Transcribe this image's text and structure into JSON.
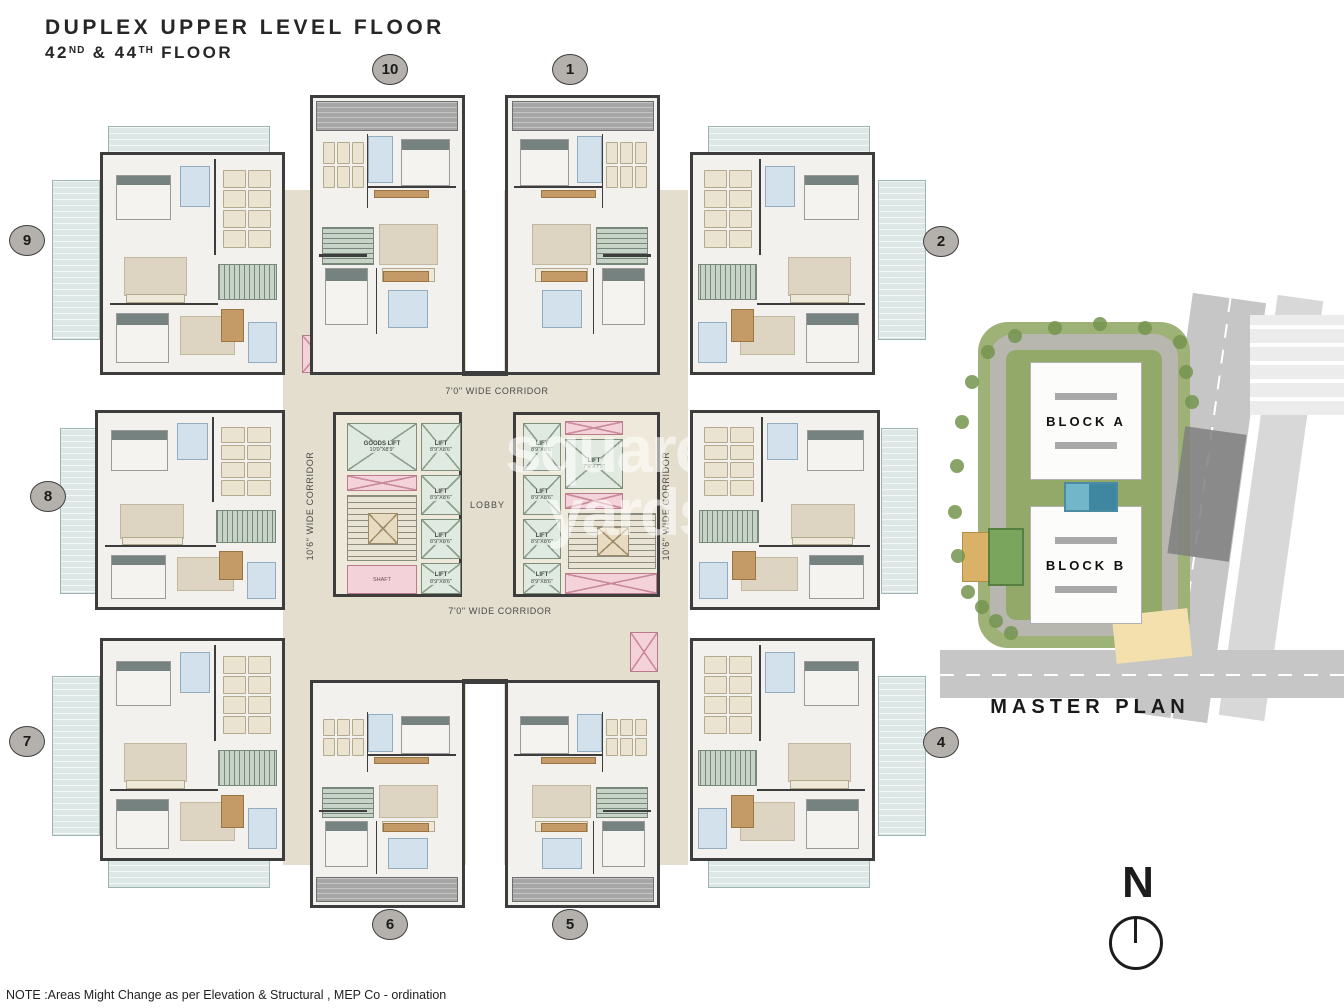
{
  "title": {
    "line1": "DUPLEX UPPER LEVEL FLOOR",
    "floor_num_1": "42",
    "floor_suffix_1": "ND",
    "floor_mid": " & ",
    "floor_num_2": "44",
    "floor_suffix_2": "TH",
    "floor_word": " FLOOR"
  },
  "corridors": {
    "top": "7'0\" WIDE CORRIDOR",
    "bottom": "7'0\" WIDE CORRIDOR",
    "left": "10'6\" WIDE CORRIDOR",
    "right": "10'6\" WIDE CORRIDOR"
  },
  "core": {
    "lobby": "LOBBY",
    "shaft": "SHAFT",
    "left_bank_lifts": [
      {
        "name": "GOODS LIFT",
        "size": "10'0\"X8'9\""
      },
      {
        "name": "LIFT",
        "size": "8'9\"X8'6\""
      },
      {
        "name": "LIFT",
        "size": "8'9\"X8'6\""
      },
      {
        "name": "LIFT",
        "size": "8'9\"X8'6\""
      },
      {
        "name": "LIFT",
        "size": "8'9\"X8'6\""
      }
    ],
    "right_bank_lifts": [
      {
        "name": "LIFT",
        "size": "8'9\"X8'6\""
      },
      {
        "name": "LIFT",
        "size": "7'9\"X7'9\""
      },
      {
        "name": "LIFT",
        "size": "8'9\"X8'6\""
      },
      {
        "name": "LIFT",
        "size": "8'9\"X8'6\""
      },
      {
        "name": "LIFT",
        "size": "8'9\"X8'6\""
      }
    ]
  },
  "unit_circles": [
    "10",
    "1",
    "9",
    "2",
    "8",
    "7",
    "4",
    "6",
    "5"
  ],
  "master_plan": {
    "title": "MASTER PLAN",
    "block_a": "BLOCK A",
    "block_b": "BLOCK B"
  },
  "compass": {
    "label": "N"
  },
  "watermark": {
    "line1": "square",
    "line2": "yards"
  },
  "note": "NOTE :Areas Might Change as per Elevation & Structural , MEP Co - ordination",
  "colors": {
    "corridor": "#e4decf",
    "wall": "#3d3d3d",
    "lift_green": "#e0eae0",
    "service_pink": "#f4d2da",
    "terrace_blue": "#dde7e5",
    "stairs_green": "#c8d3c8",
    "circle_gray": "#b4b1ac"
  }
}
